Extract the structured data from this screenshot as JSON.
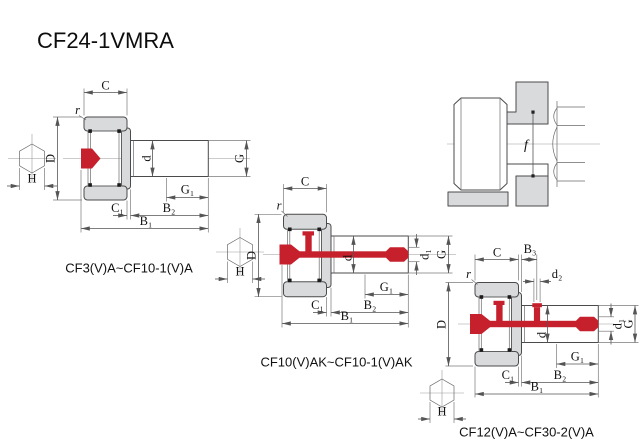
{
  "title": "CF24-1VMRA",
  "colors": {
    "accent_red": "#c5202c",
    "part_gray": "#d9dadc",
    "outline": "#4b4b4b",
    "dim_line": "#555555",
    "background": "#ffffff"
  },
  "diagrams": {
    "d1": {
      "caption": "CF3(V)A~CF10-1(V)A",
      "labels": {
        "C": "C",
        "r": "r",
        "D": "D",
        "H": "H",
        "d": "d",
        "G": "G",
        "G1": "G₁",
        "C1": "C₁",
        "B2": "B₂",
        "B1": "B₁"
      }
    },
    "d2": {
      "caption": "CF10(V)AK~CF10-1(V)AK",
      "labels": {
        "C": "C",
        "r": "r",
        "D": "D",
        "H": "H",
        "d": "d",
        "d1": "d₁",
        "G": "G",
        "G1": "G₁",
        "C1": "C₁",
        "B2": "B₂",
        "B1": "B₁"
      }
    },
    "d3": {
      "caption": "CF12(V)A~CF30-2(V)A",
      "labels": {
        "C": "C",
        "B3": "B₃",
        "d2": "d₂",
        "r": "r",
        "D": "D",
        "H": "H",
        "d": "d",
        "d1": "d₁",
        "G": "G",
        "G1": "G₁",
        "C1": "C₁",
        "B2": "B₂",
        "B1": "B₁"
      }
    },
    "mount": {
      "labels": {
        "f": "f"
      }
    }
  }
}
